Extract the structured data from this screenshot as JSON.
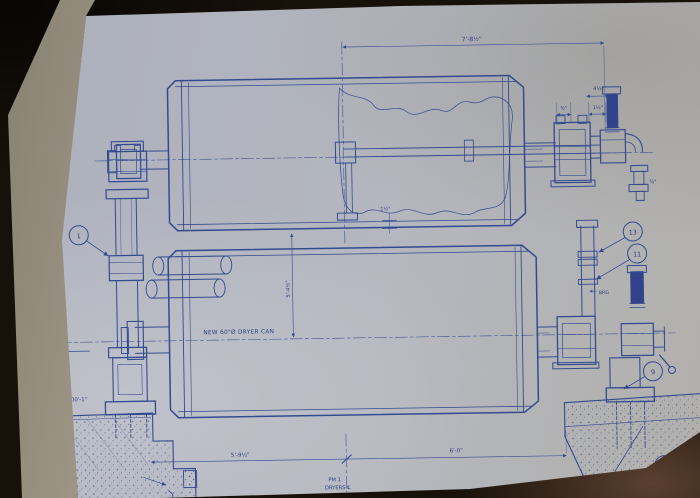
{
  "photo": {
    "surface_color": "#171109",
    "paper_color": "#b2b5bd",
    "under_page_color": "#b6b0a1",
    "ink_color": "#344a90"
  },
  "drawing": {
    "annotations": {
      "dryer_note": "NEW 60\"Ø DRYER CAN",
      "ts_label": "T.S.",
      "ts_elevation": "102'-4\"",
      "base_elevation": "EL 100'-1\"",
      "brg_label": "BRG",
      "pm_centerline_line1": "PM 1",
      "pm_centerline_line2": "DRYERS ℄"
    },
    "dimensions": {
      "top_span": "7'-8½\"",
      "pipe_offset": "4½\"",
      "half": "½\"",
      "one_and_half": "1½\"",
      "rod_step": "1½\"",
      "five_eighths": "⅝\"",
      "dryer_centerline_spacing": "5'-4½\"",
      "bottom_left_span": "5'-9½\"",
      "bottom_right_span": "6'-0\""
    },
    "callouts": {
      "c1": "1",
      "c13": "13",
      "c11_upper": "11",
      "c9": "9",
      "c11_lower": "11"
    },
    "corner_note": {
      "line1": "TER",
      "line2": "CK BEAM",
      "line3": "JAN-27-07",
      "line4": "ILS"
    }
  }
}
